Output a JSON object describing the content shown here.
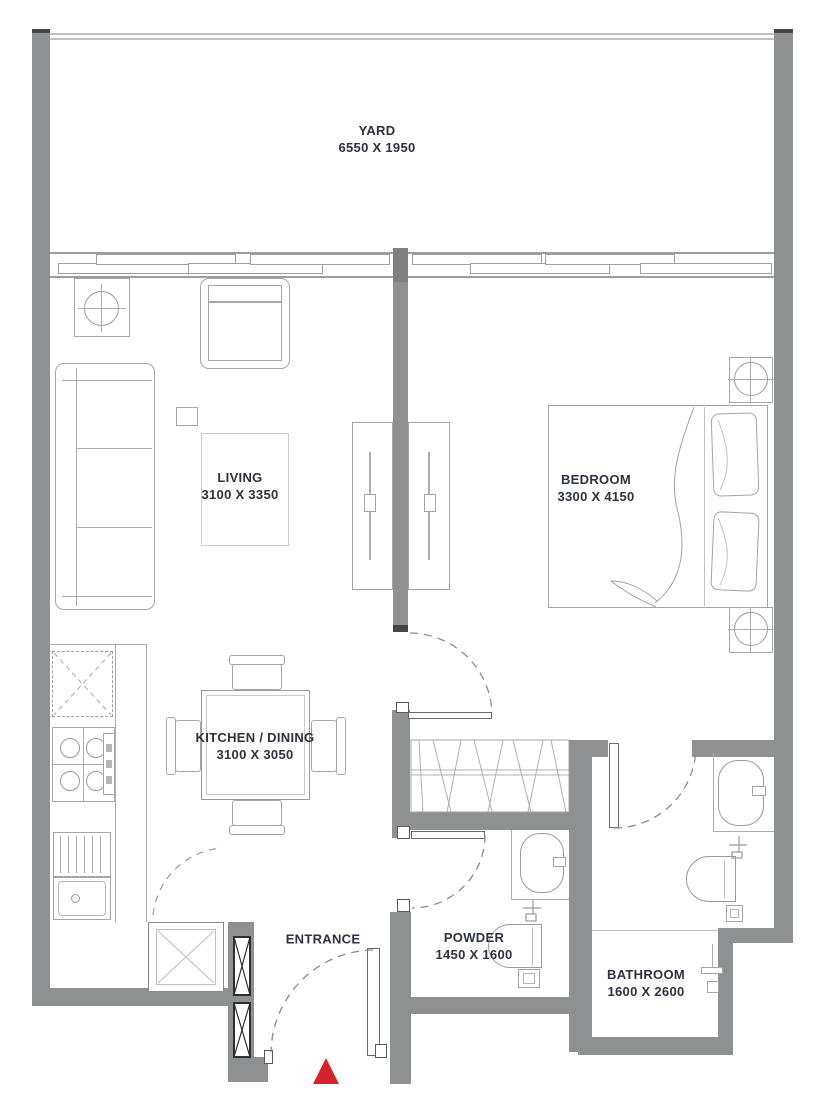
{
  "plan": {
    "rooms": {
      "yard": {
        "name": "YARD",
        "dims": "6550 X 1950"
      },
      "living": {
        "name": "LIVING",
        "dims": "3100 X 3350"
      },
      "bedroom": {
        "name": "BEDROOM",
        "dims": "3300 X 4150"
      },
      "kitchen": {
        "name": "KITCHEN / DINING",
        "dims": "3100 X 3050"
      },
      "powder": {
        "name": "POWDER",
        "dims": "1450 X 1600"
      },
      "bathroom": {
        "name": "BATHROOM",
        "dims": "1600 X 2600"
      }
    },
    "entrance": {
      "label": "ENTRANCE"
    },
    "colors": {
      "wall": "#8f9092",
      "entrance_marker": "#d2242a",
      "label_text": "#2e3240",
      "fixture_line": "#a6a6a6"
    }
  }
}
